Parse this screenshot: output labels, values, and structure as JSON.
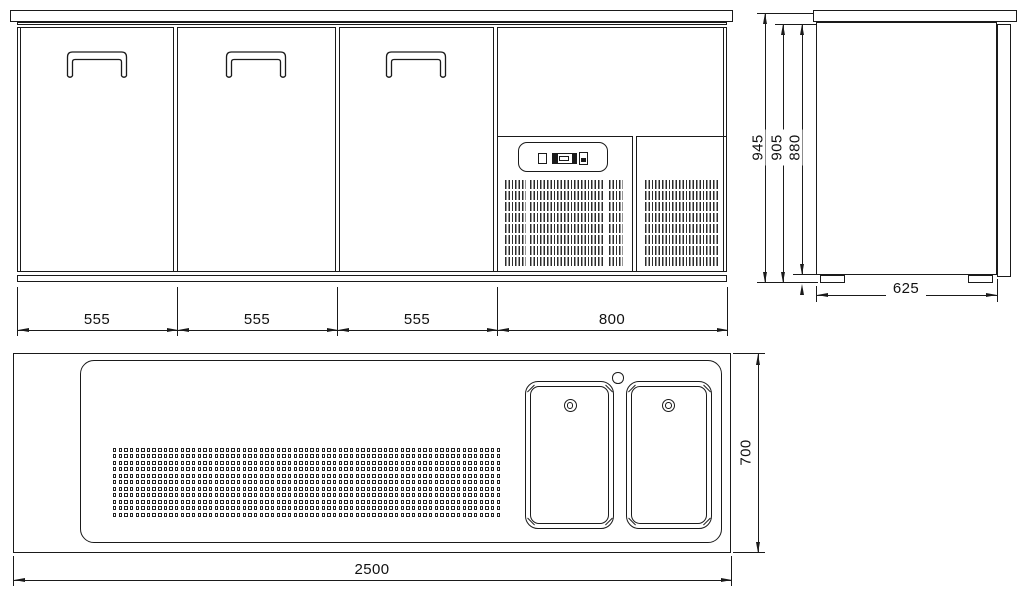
{
  "views": {
    "front": {
      "label": "front-elevation",
      "section_widths": [
        "555",
        "555",
        "555",
        "800"
      ]
    },
    "side": {
      "label": "side-elevation",
      "heights": [
        "945",
        "905",
        "880"
      ],
      "depth": "625"
    },
    "plan": {
      "label": "plan-view",
      "overall_width": "2500",
      "overall_depth": "700"
    }
  },
  "colors": {
    "line": "#1a1a1a",
    "background": "#ffffff"
  }
}
